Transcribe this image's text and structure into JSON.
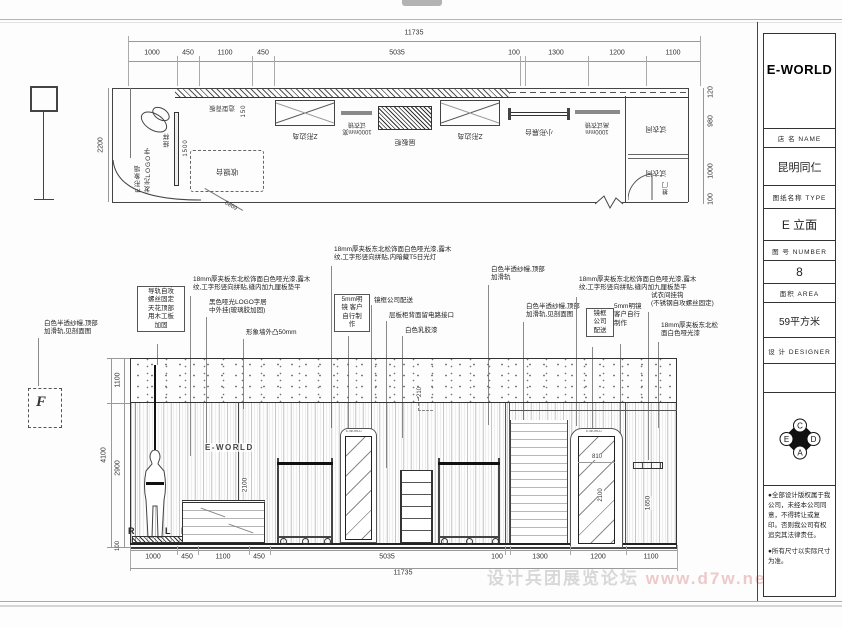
{
  "page": {
    "watermark_cn": "设计兵团展览论坛",
    "watermark_url": " www.d7w.net/forum"
  },
  "title_block": {
    "brand": "E-WORLD",
    "rows": [
      {
        "label": "店  名  NAME",
        "value": "昆明同仁"
      },
      {
        "label": "图纸名称  TYPE",
        "value": "E 立面"
      },
      {
        "label": "图  号  NUMBER",
        "value": "8"
      },
      {
        "label": "面积  AREA",
        "value": "59平方米"
      },
      {
        "label": "设  计  DESIGNER",
        "value": ""
      }
    ],
    "logo_letters": {
      "top": "C",
      "left": "E",
      "right": "D",
      "bottom": "A"
    },
    "notes": [
      "●全部设计版权属于我公司，未经本公司同意，不得转让或复印。否则我公司有权追究其法律责任。",
      "●所有尺寸以实际尺寸为准。"
    ]
  },
  "plan": {
    "dim_total": "11735",
    "dims_top": [
      "1000",
      "450",
      "1100",
      "450",
      "5035",
      "100",
      "1300",
      "1200",
      "1100"
    ],
    "dim_left": "2200",
    "dims_right": [
      "120",
      "980",
      "1000",
      "100"
    ],
    "labels": {
      "image_wall": "E形象墙\n发光LOGO字",
      "hang": "挂样",
      "hang_dim": "1500",
      "cashier": "收银台",
      "back_panel": "造型背板",
      "back_panel_dim": "150",
      "z_island_1": "Z形边岛",
      "mirror_1": "1000mm宽\n试衣镜",
      "shelf": "层板柜",
      "z_island_2": "Z形边岛",
      "small_stand": "小形展台",
      "mirror_2": "1000mm\n高试衣镜",
      "fitting_room_1": "试衣间",
      "fitting_room_2": "试衣间",
      "door": "推门",
      "diag_dim": "6980"
    }
  },
  "elevation": {
    "dim_total": "11735",
    "dims_bottom": [
      "1000",
      "450",
      "1100",
      "450",
      "5035",
      "100",
      "1300",
      "1200",
      "1100"
    ],
    "dims_left": {
      "total": "4100",
      "top": "1100",
      "mid": "2900",
      "base": "100"
    },
    "wall_logo": "E-WORLD",
    "window_letters": {
      "l1": "R",
      "l2": "L",
      "l3": "D"
    },
    "mirror1_logo": "E-WORLD",
    "mirror2_logo": "E-WORLD",
    "dims_inner": {
      "cabinet_h": "2100",
      "step": "210",
      "mirror2_w": "810",
      "mirror2_h": "2100",
      "right_h": "1650"
    },
    "marker_f": "F"
  },
  "annotations": [
    {
      "text": "导轨自攻\n螺丝固定\n天花顶部\n用木工板\n加固"
    },
    {
      "text": "白色半透纱幔,顶部\n加滑轨,见剖面图"
    },
    {
      "text": "18mm厚夹板东北松饰面白色哑光漆,露木\n纹,工字形竖向拼贴,缝内加九厘板垫平"
    },
    {
      "text": "黑色哑光LOGO字居\n中外挂(玻璃胶加固)"
    },
    {
      "text": "形象墙外凸50mm"
    },
    {
      "text": "18mm厚夹板东北松饰面白色哑光漆,露木\n纹,工字形竖向拼贴,内暗藏T5日光灯"
    },
    {
      "text": "5mm明\n镜 客户\n自行制\n作"
    },
    {
      "text": "镜框公司配送"
    },
    {
      "text": "层板柜背面留电路接口"
    },
    {
      "text": "白色乳胶漆"
    },
    {
      "text": "白色半透纱幔,顶部\n加滑轨"
    },
    {
      "text": "白色半透纱幔,顶部\n加滑轨,见剖面图"
    },
    {
      "text": "18mm厚夹板东北松饰面白色哑光漆,露木\n纹,工字形竖向拼贴,缝内加九厘板垫平"
    },
    {
      "text": "镜框\n公司\n配送"
    },
    {
      "text": "5mm明镜\n客户自行\n制作"
    },
    {
      "text": "试衣间挂钩\n(不锈钢自攻螺丝固定)"
    },
    {
      "text": "18mm厚夹板东北松\n面白色哑光漆"
    }
  ]
}
